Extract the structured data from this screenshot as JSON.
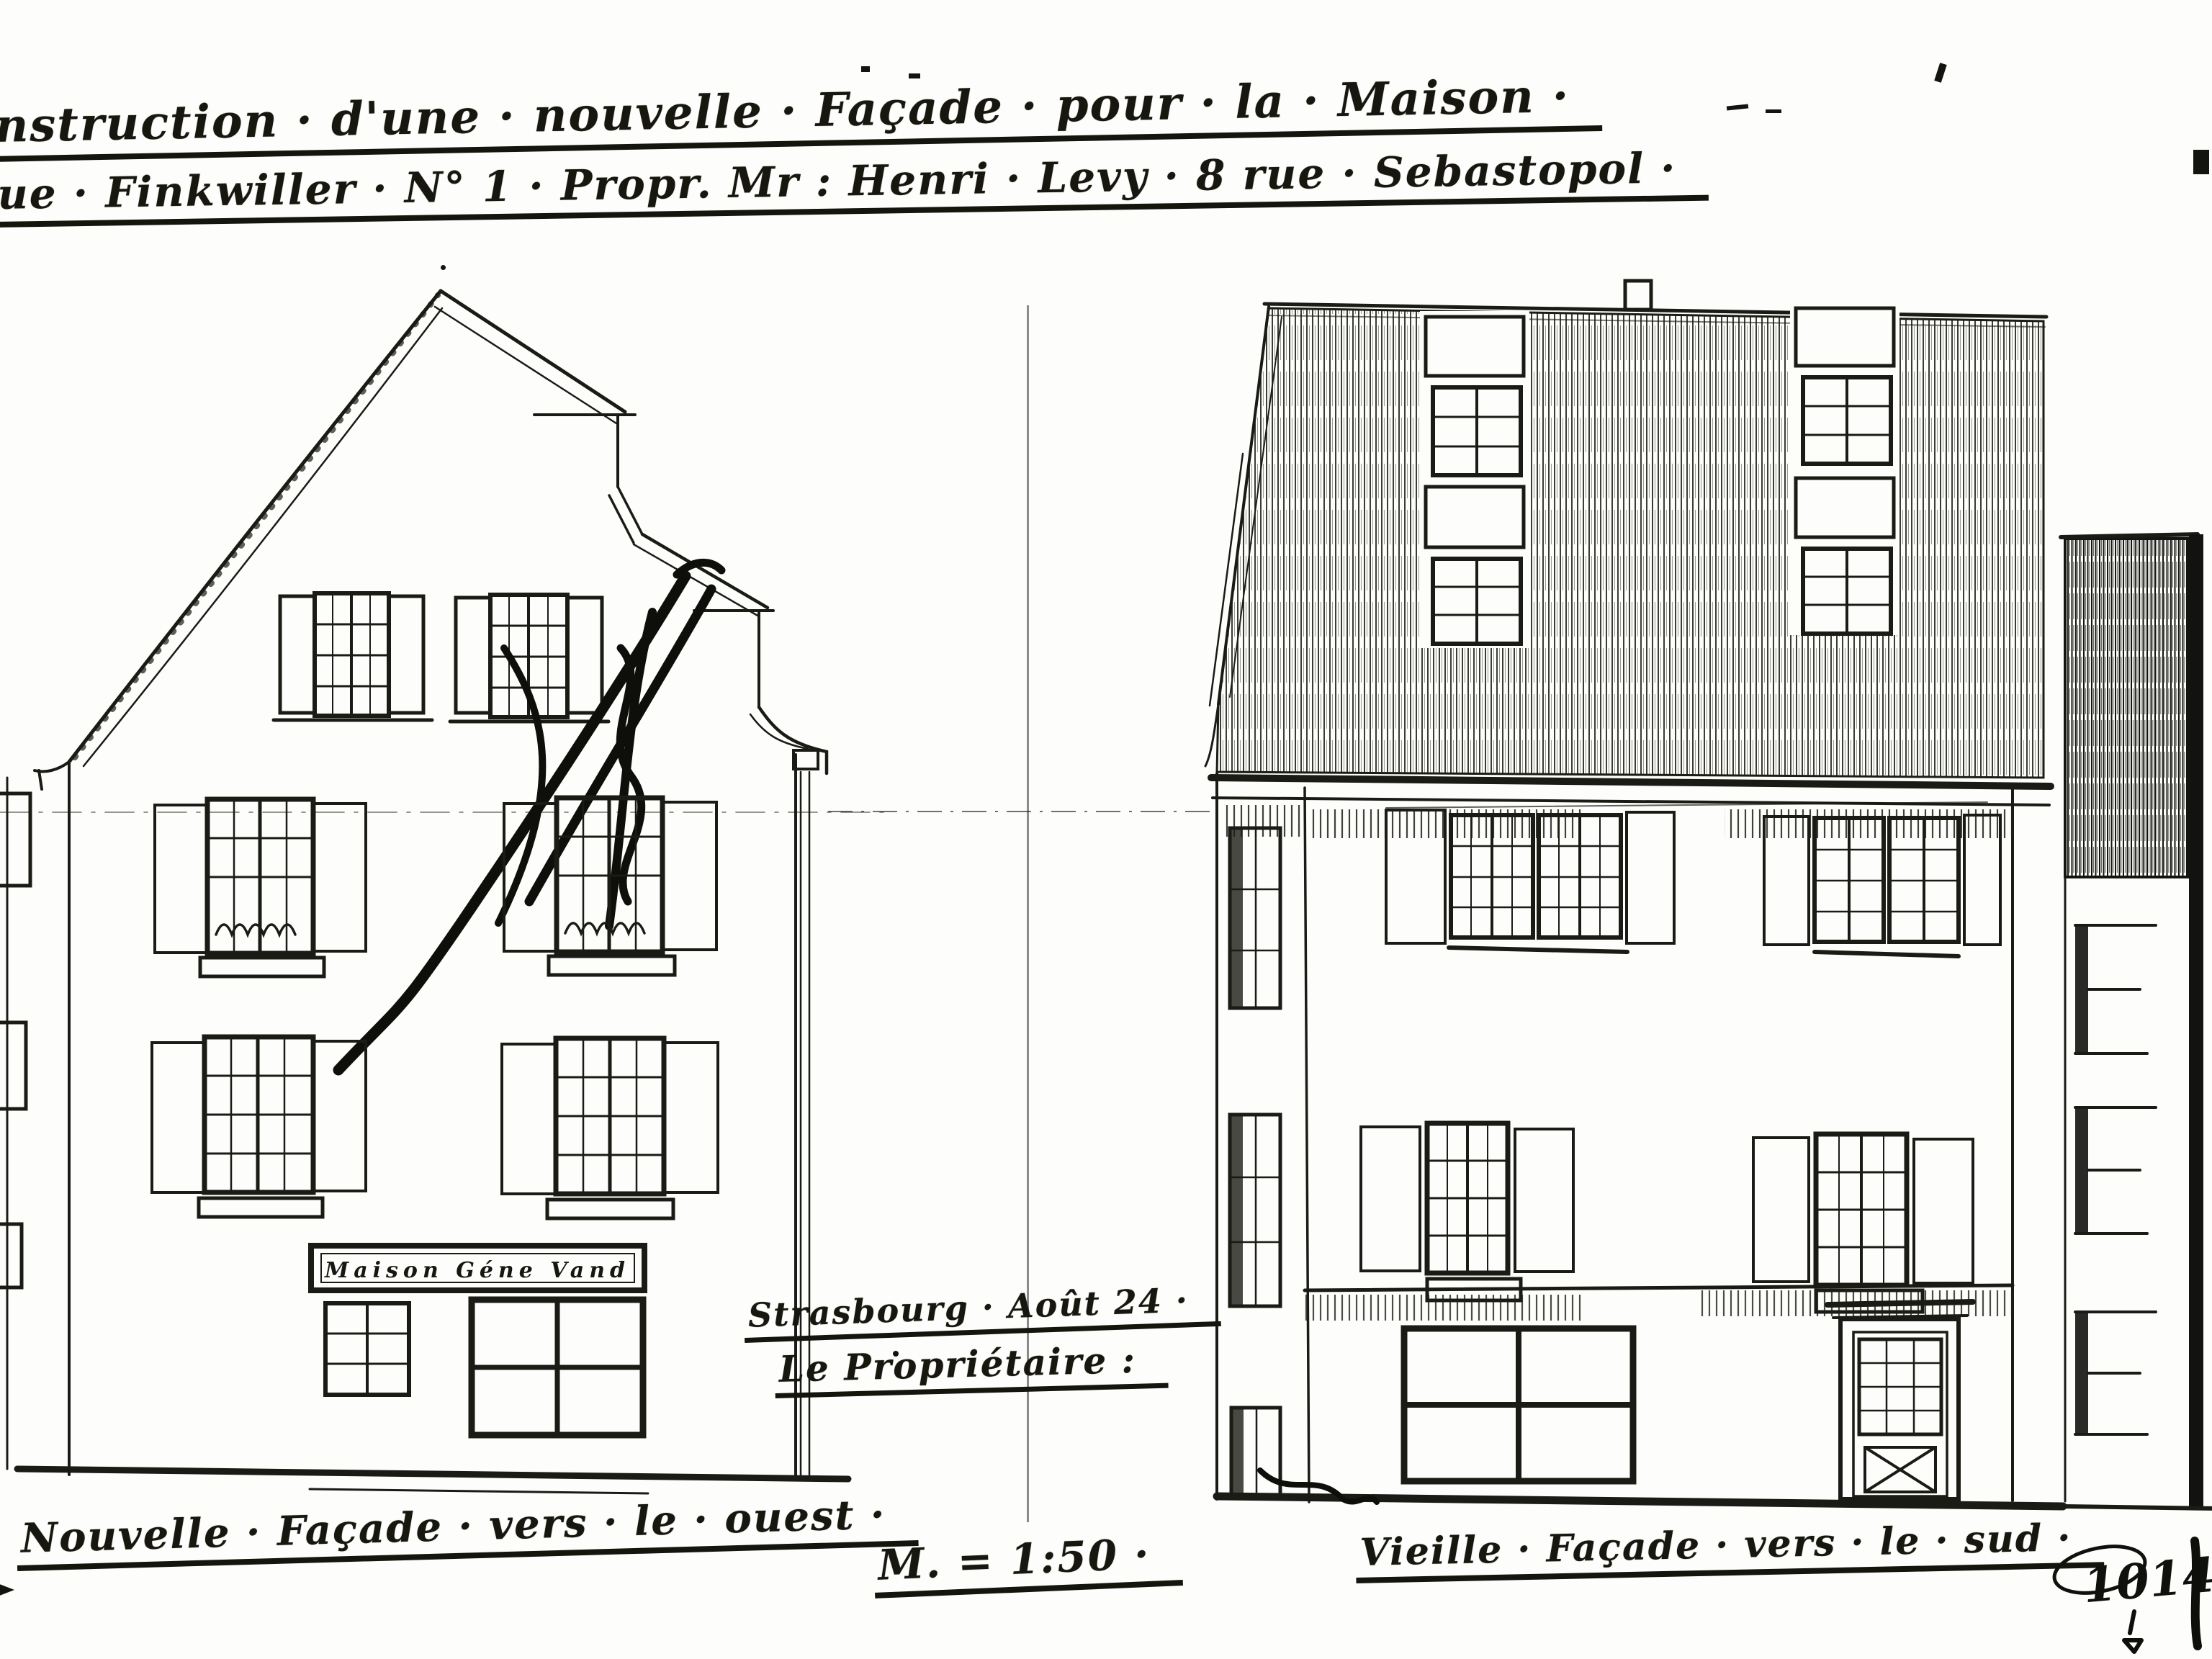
{
  "doc": {
    "header": {
      "line1": "nstruction · d'une · nouvelle · Façade · pour · la · Maison ·",
      "line2": "ue · Finkwiller · N° 1 ·  Propr. Mr :  Henri · Levy ·  8 rue · Sebastopol ·"
    },
    "note": {
      "line1": "Strasbourg ·  Août 24 ·",
      "line2": "Le Propriétaire :"
    },
    "scale_label": "M. = 1:50 ·",
    "captions": {
      "left": "Nouvelle · Façade · vers · le · ouest ·",
      "right": "Vieille · Façade · vers · le · sud ·"
    },
    "left_elevation_shop_sign": "Maison Géne Vand",
    "signature": "1014",
    "style": {
      "ink": "#17170f",
      "paper": "#fdfdfb"
    }
  }
}
